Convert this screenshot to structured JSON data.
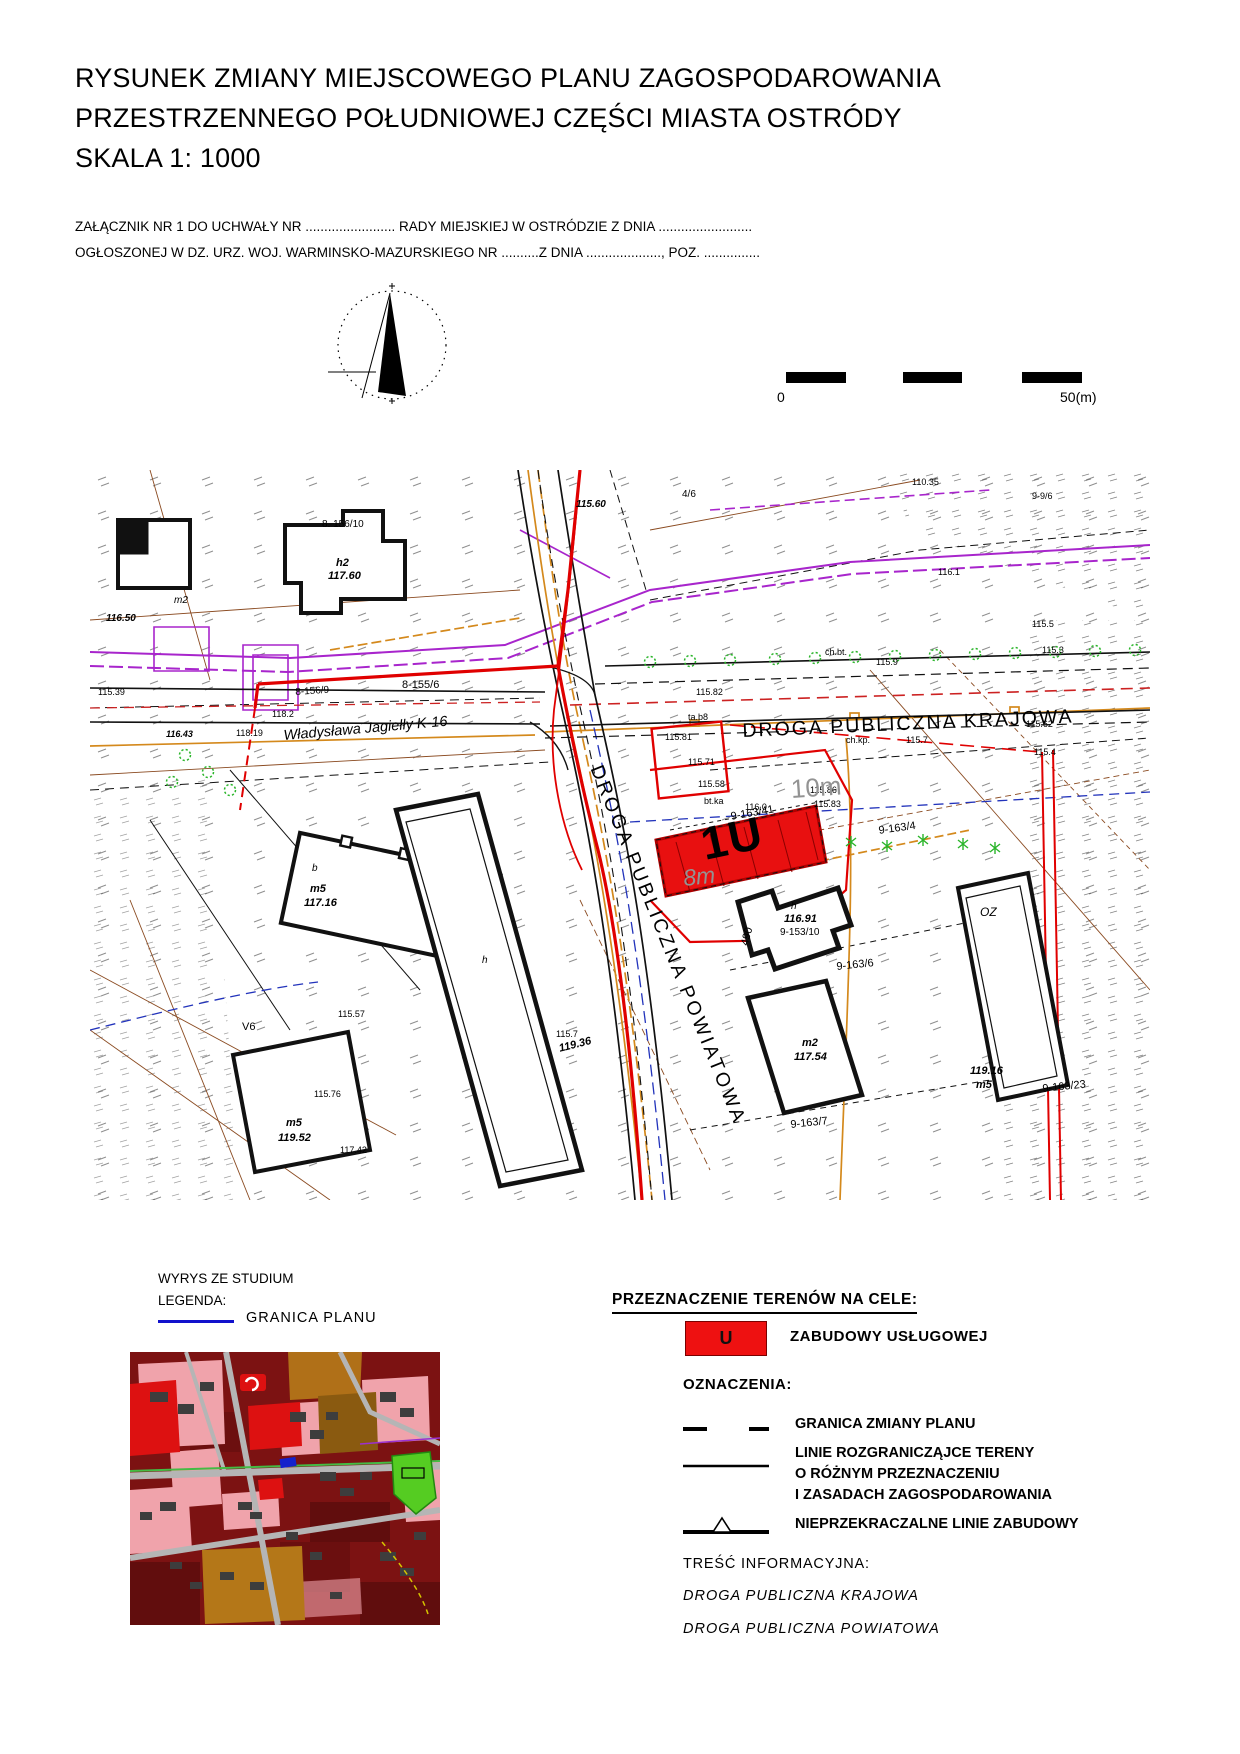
{
  "title": {
    "line1": "RYSUNEK ZMIANY MIEJSCOWEGO PLANU ZAGOSPODAROWANIA",
    "line2": "PRZESTRZENNEGO  POŁUDNIOWEJ CZĘŚCI MIASTA OSTRÓDY",
    "line3": "SKALA  1: 1000"
  },
  "attachment": {
    "line1": "ZAŁĄCZNIK NR 1 DO UCHWAŁY NR ........................ RADY MIEJSKIEJ W OSTRÓDZIE Z DNIA .........................",
    "line2": "OGŁOSZONEJ W DZ. URZ. WOJ. WARMINSKO-MAZURSKIEGO NR ..........Z DNIA ...................., POZ. ..............."
  },
  "scalebar": {
    "zero": "0",
    "fifty": "50(m)"
  },
  "colors": {
    "plan_red": "#ee1111",
    "granica_blue": "#1111cc",
    "utility_magenta": "#a825cc",
    "utility_orange": "#d4891c"
  },
  "map": {
    "road_main": "DROGA PUBLICZNA KRAJOWA",
    "road_secondary": "DROGA PUBLICZNA POWIATOWA",
    "street": "Władysława Jagiełły K-16",
    "zone_label": "1U",
    "labels": [
      {
        "t": "8. 156/10",
        "x": 232,
        "y": 50,
        "fs": 10
      },
      {
        "t": "h2",
        "x": 246,
        "y": 88,
        "fs": 11,
        "b": 1,
        "i": 1
      },
      {
        "t": "117.60",
        "x": 238,
        "y": 101,
        "fs": 11,
        "b": 1,
        "i": 1
      },
      {
        "t": "m2",
        "x": 84,
        "y": 126,
        "fs": 10,
        "i": 1
      },
      {
        "t": "116.50",
        "x": 16,
        "y": 144,
        "fs": 10,
        "b": 1,
        "i": 1
      },
      {
        "t": "115.60",
        "x": 486,
        "y": 30,
        "fs": 10,
        "b": 1,
        "i": 1
      },
      {
        "t": "4/6",
        "x": 592,
        "y": 20,
        "fs": 10
      },
      {
        "t": "110.35",
        "x": 822,
        "y": 8,
        "fs": 9
      },
      {
        "t": "9-9/6",
        "x": 942,
        "y": 22,
        "fs": 9
      },
      {
        "t": "116.1",
        "x": 848,
        "y": 98,
        "fs": 9
      },
      {
        "t": "115.5",
        "x": 942,
        "y": 150,
        "fs": 9
      },
      {
        "t": "115.3",
        "x": 952,
        "y": 176,
        "fs": 9
      },
      {
        "t": "115.62",
        "x": 936,
        "y": 250,
        "fs": 9
      },
      {
        "t": "115.4",
        "x": 944,
        "y": 278,
        "fs": 9
      },
      {
        "t": "115.9",
        "x": 786,
        "y": 188,
        "fs": 9
      },
      {
        "t": "ch.bt.",
        "x": 735,
        "y": 178,
        "fs": 9
      },
      {
        "t": "115.82",
        "x": 606,
        "y": 218,
        "fs": 9
      },
      {
        "t": "ta.b8",
        "x": 598,
        "y": 243,
        "fs": 9
      },
      {
        "t": "115.81",
        "x": 575,
        "y": 263,
        "fs": 9
      },
      {
        "t": "ch.kp.",
        "x": 756,
        "y": 266,
        "fs": 9
      },
      {
        "t": "115.71",
        "x": 598,
        "y": 288,
        "fs": 9
      },
      {
        "t": "115.58",
        "x": 608,
        "y": 310,
        "fs": 9
      },
      {
        "t": "115.7",
        "x": 816,
        "y": 266,
        "fs": 9
      },
      {
        "t": "115.86",
        "x": 720,
        "y": 316,
        "fs": 9
      },
      {
        "t": "115.83",
        "x": 724,
        "y": 330,
        "fs": 9
      },
      {
        "t": "116.0",
        "x": 655,
        "y": 333,
        "fs": 9
      },
      {
        "t": "bt.ka",
        "x": 614,
        "y": 327,
        "fs": 9
      },
      {
        "t": "8-155/6",
        "x": 312,
        "y": 210,
        "fs": 11
      },
      {
        "t": "8-156/9",
        "x": 205,
        "y": 218,
        "fs": 10,
        "r": -4
      },
      {
        "t": "118.2",
        "x": 182,
        "y": 240,
        "fs": 9
      },
      {
        "t": "116.43",
        "x": 76,
        "y": 260,
        "fs": 9,
        "b": 1,
        "i": 1
      },
      {
        "t": "118.19",
        "x": 146,
        "y": 259,
        "fs": 9
      },
      {
        "t": "115.39",
        "x": 8,
        "y": 218,
        "fs": 9
      },
      {
        "t": "10m",
        "x": 700,
        "y": 306,
        "fs": 26,
        "c": "g",
        "r": -4
      },
      {
        "t": "8m",
        "x": 592,
        "y": 396,
        "fs": 23,
        "c": "g",
        "i": 1,
        "r": -6
      },
      {
        "t": "9-163/41",
        "x": 640,
        "y": 342,
        "fs": 11,
        "r": -10
      },
      {
        "t": "9-163/4",
        "x": 788,
        "y": 356,
        "fs": 11,
        "r": -8
      },
      {
        "t": "9-163/6",
        "x": 746,
        "y": 492,
        "fs": 11,
        "r": -6
      },
      {
        "t": "9-163/23",
        "x": 952,
        "y": 614,
        "fs": 11,
        "r": -6
      },
      {
        "t": "9-163/7",
        "x": 700,
        "y": 650,
        "fs": 11,
        "r": -6
      },
      {
        "t": "h",
        "x": 701,
        "y": 432,
        "fs": 10,
        "i": 1
      },
      {
        "t": "116.91",
        "x": 694,
        "y": 444,
        "fs": 11,
        "b": 1,
        "i": 1
      },
      {
        "t": "9-153/10",
        "x": 690,
        "y": 458,
        "fs": 10
      },
      {
        "t": "490",
        "x": 650,
        "y": 474,
        "fs": 11,
        "r": -75
      },
      {
        "t": "m2",
        "x": 712,
        "y": 568,
        "fs": 11,
        "b": 1,
        "i": 1
      },
      {
        "t": "117.54",
        "x": 704,
        "y": 582,
        "fs": 11,
        "b": 1,
        "i": 1
      },
      {
        "t": "OZ",
        "x": 890,
        "y": 436,
        "fs": 12,
        "i": 1
      },
      {
        "t": "119.16",
        "x": 880,
        "y": 596,
        "fs": 11,
        "b": 1,
        "i": 1
      },
      {
        "t": "m5",
        "x": 886,
        "y": 610,
        "fs": 11,
        "b": 1,
        "i": 1
      },
      {
        "t": "b",
        "x": 222,
        "y": 394,
        "fs": 10,
        "i": 1
      },
      {
        "t": "m5",
        "x": 220,
        "y": 414,
        "fs": 11,
        "b": 1,
        "i": 1
      },
      {
        "t": "117.16",
        "x": 214,
        "y": 428,
        "fs": 11,
        "b": 1,
        "i": 1
      },
      {
        "t": "h",
        "x": 392,
        "y": 486,
        "fs": 10,
        "i": 1
      },
      {
        "t": "115.7",
        "x": 466,
        "y": 560,
        "fs": 9
      },
      {
        "t": "119.36",
        "x": 468,
        "y": 574,
        "fs": 11,
        "b": 1,
        "i": 1,
        "r": -14
      },
      {
        "t": "V6",
        "x": 152,
        "y": 552,
        "fs": 11
      },
      {
        "t": "115.57",
        "x": 248,
        "y": 540,
        "fs": 9
      },
      {
        "t": "115.76",
        "x": 224,
        "y": 620,
        "fs": 9
      },
      {
        "t": "117.42",
        "x": 250,
        "y": 676,
        "fs": 9
      },
      {
        "t": "m5",
        "x": 196,
        "y": 648,
        "fs": 11,
        "b": 1,
        "i": 1
      },
      {
        "t": "119.52",
        "x": 188,
        "y": 663,
        "fs": 11,
        "b": 1,
        "i": 1
      }
    ]
  },
  "study": {
    "title": "WYRYS ZE STUDIUM",
    "legend_heading": "LEGENDA:",
    "granica_label": "GRANICA PLANU"
  },
  "legend": {
    "title": "PRZEZNACZENIE TERENÓW NA CELE:",
    "u_symbol": "U",
    "u_label": "ZABUDOWY USŁUGOWEJ",
    "oznaczenia": "OZNACZENIA:",
    "items": [
      {
        "symbol": "dash-pair",
        "label": "GRANICA ZMIANY PLANU"
      },
      {
        "symbol": "solid-line",
        "lines": [
          "LINIE ROZGRANICZĄJCE TERENY",
          "O RÓŻNYM PRZEZNACZENIU",
          "I ZASADACH ZAGOSPODAROWANIA"
        ]
      },
      {
        "symbol": "triangle-line",
        "label": "NIEPRZEKRACZALNE LINIE ZABUDOWY"
      }
    ],
    "tresc": "TREŚĆ INFORMACYJNA:",
    "info1": "DROGA PUBLICZNA KRAJOWA",
    "info2": "DROGA PUBLICZNA POWIATOWA"
  }
}
